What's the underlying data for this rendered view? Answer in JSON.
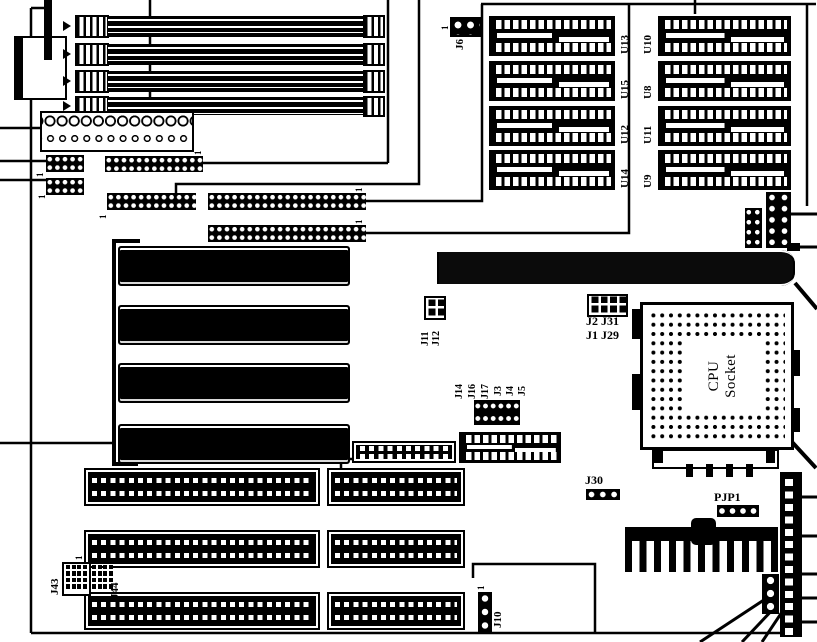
{
  "chips_left": [
    "U13",
    "U15",
    "U12",
    "U14"
  ],
  "chips_right": [
    "U10",
    "U8",
    "U11",
    "U9"
  ],
  "cpu": {
    "line1": "CPU",
    "line2": "Socket"
  },
  "labels": {
    "j6": "J6",
    "j2_j31": "J2 J31",
    "j1_j29": "J1 J29",
    "j11": "J11",
    "j12": "J12",
    "j14": "J14",
    "j16": "J16",
    "j17": "J17",
    "j3": "J3",
    "j4": "J4",
    "j5": "J5",
    "u4": "U4",
    "j30": "J30",
    "pjp1": "PJP1",
    "j10": "J10",
    "j43": "J43",
    "j44": "J44",
    "pin1": "1"
  }
}
